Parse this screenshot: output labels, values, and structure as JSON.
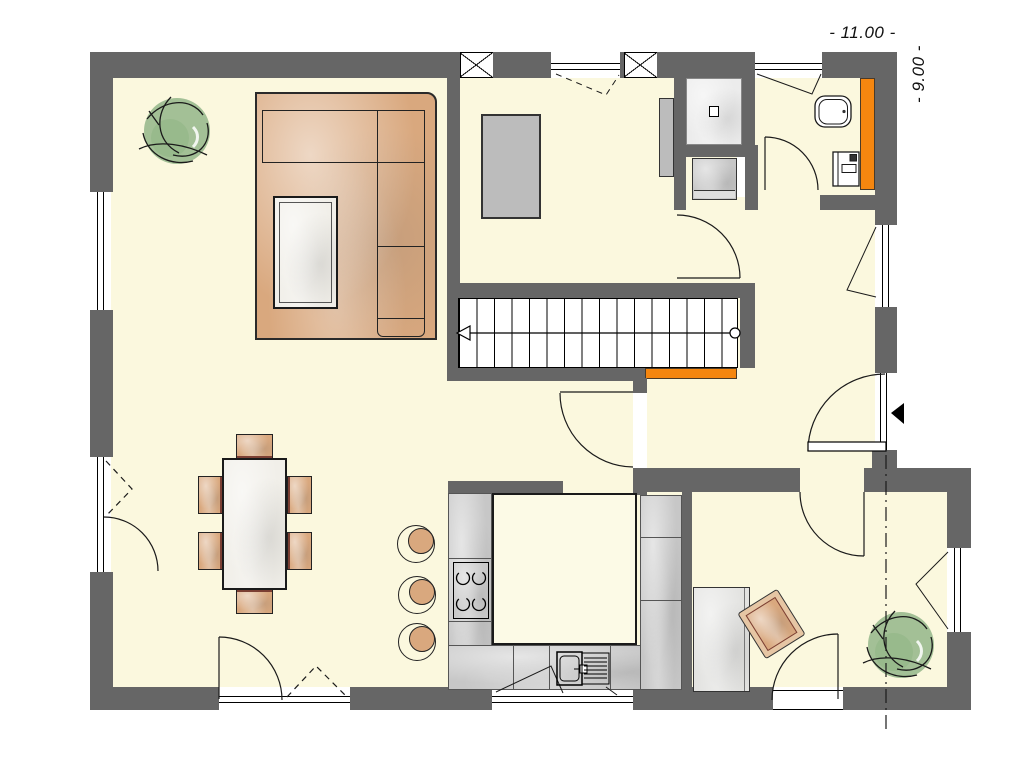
{
  "plan": {
    "dimension_width_label": "- 11.00 -",
    "dimension_height_label": "- 9.00 -"
  },
  "palette": {
    "floor": "#FBF8DE",
    "wall": "#666666",
    "orange": "#F5860F",
    "tan": "#D9A87E",
    "tan_dark": "#7B3F33",
    "gray": "#BCBCBC",
    "counter": "#C7C7C7",
    "green": "#A3C096",
    "table": "#F1EFE9",
    "line": "#1A1A1A"
  },
  "stairs": {
    "treads": 16,
    "width_px": 280
  },
  "counts": {
    "dining_chairs": 6,
    "kitchen_stools": 3,
    "plants": 2
  }
}
